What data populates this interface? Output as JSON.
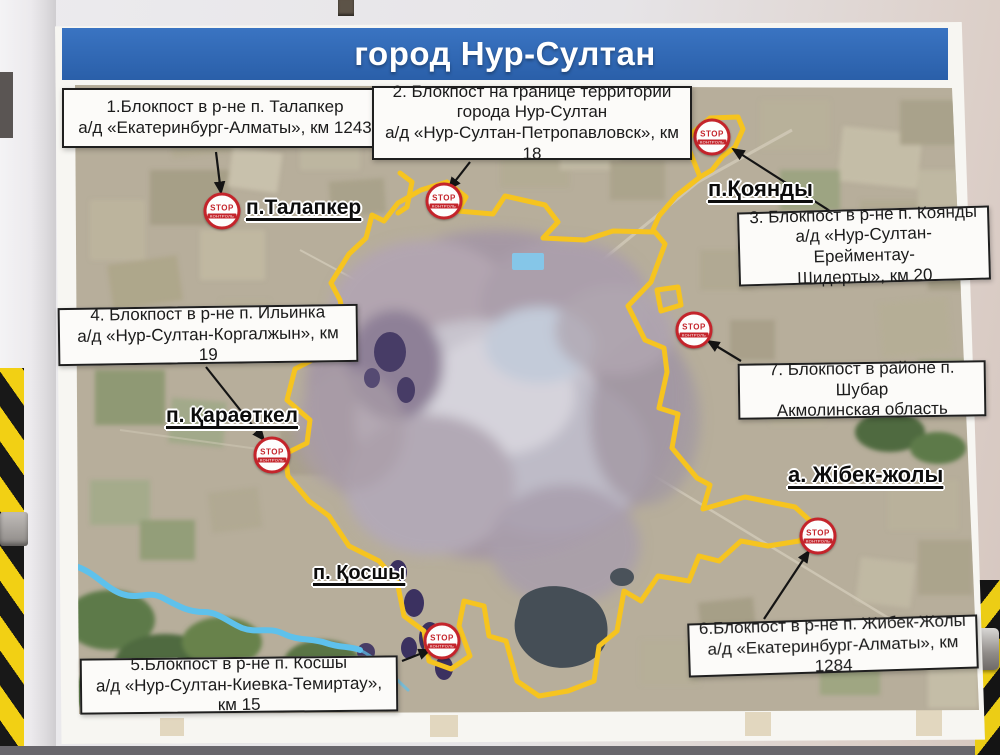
{
  "title": "город Нур-Султан",
  "callouts": [
    {
      "text": "1.Блокпост в р-не п. Талапкер\nа/д «Екатеринбург-Алматы», км 1243"
    },
    {
      "text": "2. Блокпост на границе территории\nгорода Нур-Султан\nа/д «Нур-Султан-Петропавловск», км 18"
    },
    {
      "text": "3. Блокпост в р-не п. Коянды\nа/д «Нур-Султан-Ерейментау-\nШидерты»,  км 20"
    },
    {
      "text": "4. Блокпост в р-не п. Ильинка\nа/д «Нур-Султан-Коргалжын», км 19"
    },
    {
      "text": "5.Блокпост в р-не п. Косшы\nа/д «Нур-Султан-Киевка-Темиртау», км 15"
    },
    {
      "text": "6.Блокпост в р-не п. Жибек-Жолы\nа/д «Екатеринбург-Алматы», км 1284"
    },
    {
      "text": "7. Блокпост в районе п. Шубар\nАкмолинская область"
    }
  ],
  "places": [
    {
      "label": "п.Талапкер"
    },
    {
      "label": "п.Қоянды"
    },
    {
      "label": "п. Қараөткел"
    },
    {
      "label": "п. Қосшы"
    },
    {
      "label": "а. Жібек-жолы"
    }
  ],
  "stop_sign": {
    "word": "STOP",
    "caption": "КОНТРОЛЬ"
  },
  "colors": {
    "title_bar_blue": "#2f66b0",
    "boundary_yellow": "#f6c41f",
    "stop_red": "#c4242b",
    "river_blue": "#5ec1ec"
  }
}
